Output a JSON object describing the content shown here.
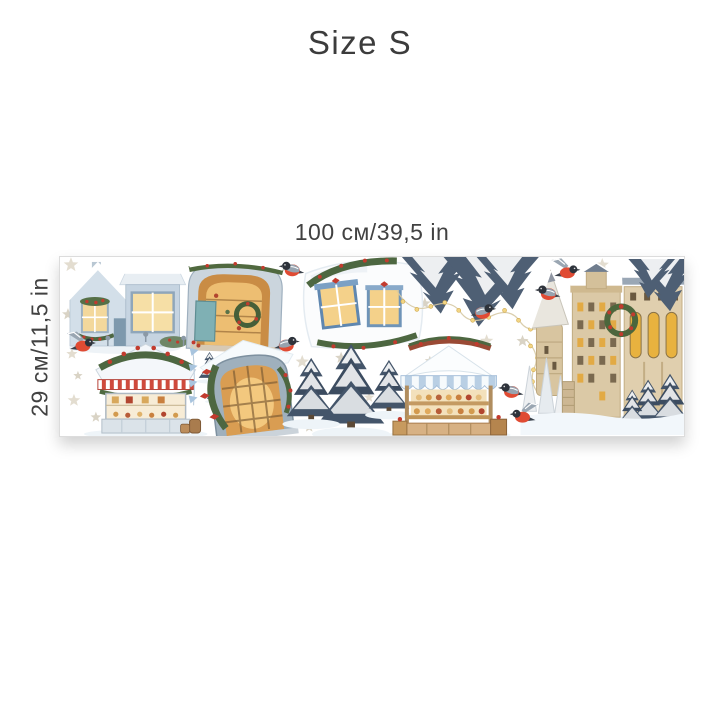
{
  "title": "Size S",
  "dimensions": {
    "width_label": "100 см/39,5 in",
    "height_label": "29 см/11,5 in"
  },
  "sheet": {
    "description": "watercolor christmas sticker sheet",
    "background": "#ffffff",
    "border_color": "#dcdcdc",
    "stickers": [
      {
        "name": "snowy-house-shopfront"
      },
      {
        "name": "arched-stone-window-with-wreath"
      },
      {
        "name": "double-window-with-garland"
      },
      {
        "name": "snowy-spruce-branches"
      },
      {
        "name": "string-lights"
      },
      {
        "name": "sweets-kiosk"
      },
      {
        "name": "arched-barn-window-with-garland"
      },
      {
        "name": "snow-covered-spruce-tree"
      },
      {
        "name": "market-stall-with-canopy"
      },
      {
        "name": "winter-castle"
      },
      {
        "name": "bullfinch-birds"
      },
      {
        "name": "beige-stars"
      }
    ],
    "colors": {
      "bird_red": "#e04b33",
      "garland_green": "#4d6741",
      "berry_red": "#c23b2e",
      "spruce_slate": "#44556a",
      "stone_beige": "#dbc9a6",
      "window_glow": "#f3cf85",
      "frame_blue": "#6f94b8",
      "awning_red": "#cf4a3c",
      "canopy_blue": "#b9cfe4",
      "star_beige": "#e3ddd0"
    }
  }
}
